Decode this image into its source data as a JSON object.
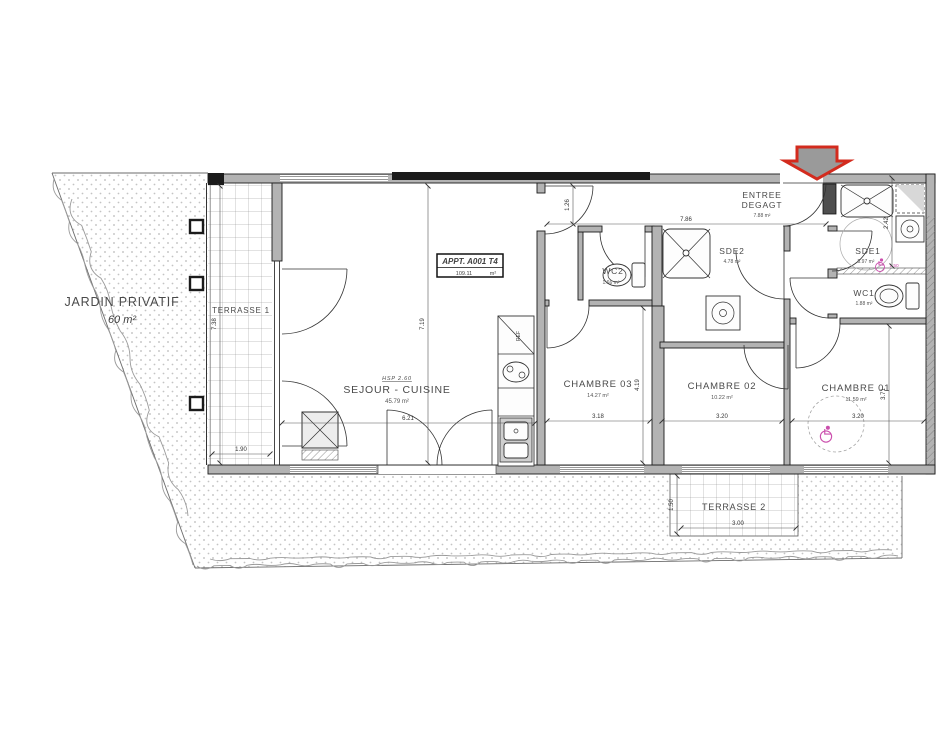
{
  "title_box": {
    "title": "APPT. A001 T4",
    "value": "109.11",
    "unit": "m²"
  },
  "rooms": {
    "jardin": {
      "name": "JARDIN PRIVATIF",
      "area": "60 m²"
    },
    "terrasse1": {
      "name": "TERRASSE 1",
      "dim_h": "7.38",
      "dim_w": "1.90"
    },
    "terrasse2": {
      "name": "TERRASSE 2",
      "dim_w": "3.00",
      "dim_h": "1.50"
    },
    "sejour": {
      "hsp": "HSP 2.60",
      "name": "SEJOUR - CUISINE",
      "area": "45.79 m²",
      "dim_w": "6.21",
      "dim_h": "7.19"
    },
    "chambre03": {
      "name": "CHAMBRE 03",
      "area": "14.27 m²",
      "dim_w": "3.18",
      "dim_h": "4.19"
    },
    "chambre02": {
      "name": "CHAMBRE 02",
      "area": "10.22 m²",
      "dim_w": "3.20"
    },
    "chambre01": {
      "name": "CHAMBRE 01",
      "area": "11.59 m²",
      "dim_w": "3.20",
      "dim_h": "3.71"
    },
    "entree": {
      "line1": "ENTREE",
      "line2": "DEGAGT",
      "area": "7.88 m²",
      "dim_w": "7.86",
      "dim_h": "1.26"
    },
    "sde2": {
      "name": "SDE2",
      "area": "4.78 m²"
    },
    "sde1": {
      "name": "SDE1",
      "area": "5.97 m²",
      "turning_circle": "1.50",
      "dim_h": "2.42"
    },
    "wc1": {
      "name": "WC1",
      "area": "1.88 m²"
    },
    "wc2": {
      "name": "WC2",
      "area": "1.66 m²"
    }
  },
  "kitchen": {
    "ref_label": "REF"
  },
  "colors": {
    "wall_fill": "#b3b3b3",
    "wall_line": "#1b1b1b",
    "entrance_arrow": "#d32b1e",
    "accessibility_pink": "#cb4fad",
    "garden_dot": "#b9b9b9"
  }
}
